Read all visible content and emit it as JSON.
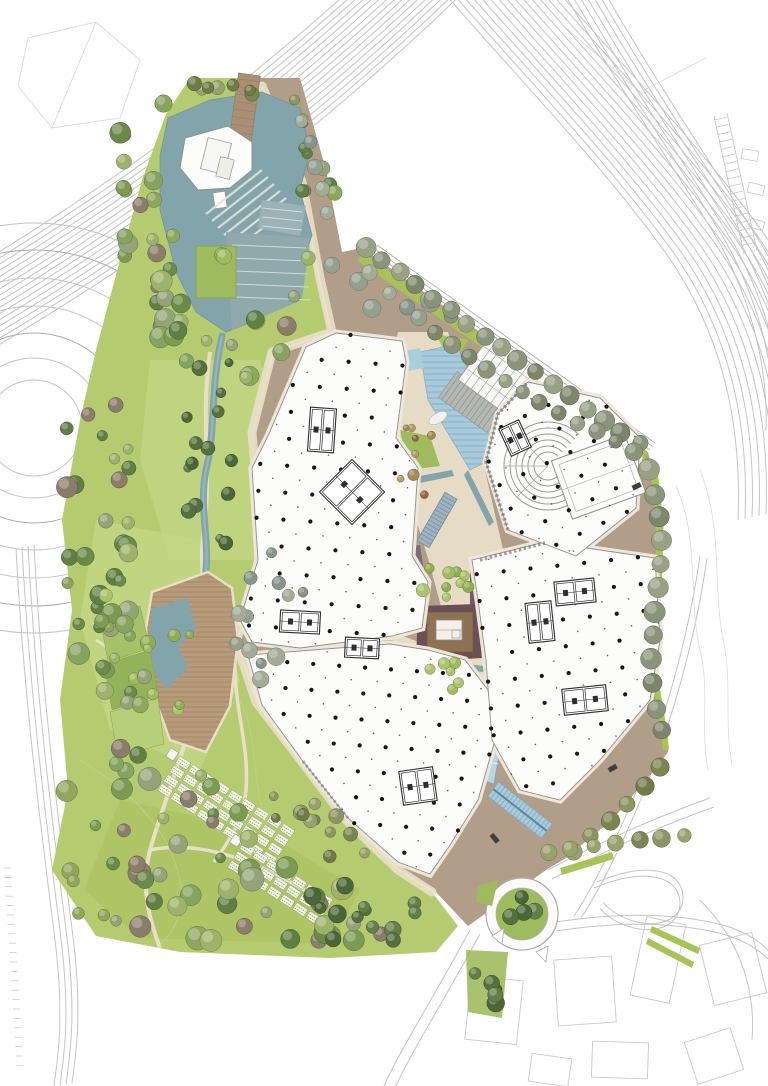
{
  "meta": {
    "type": "architectural-masterplan-site-plan",
    "description": "Rendered aerial site plan: central campus buildings with column grids, landscaped park with trees and water features, surrounded by highway infrastructure"
  },
  "colors": {
    "background": "#ffffff",
    "road_line": "#c4c4c4",
    "road_line_dark": "#ababab",
    "context_line": "#c9c9c9",
    "contour_line": "#dcdcd8",
    "meadow_contour": "#c2d08e",
    "park_green": "#b4cc6f",
    "meadow_light": "#c3d784",
    "meadow_dark": "#aac25f",
    "verge_green": "#a7c455",
    "lawn_bright": "#9ebb5e",
    "plaza_brown": "#b19e88",
    "plaza_brown_dark": "#a08c76",
    "path_cream": "#e9dfc8",
    "deck_wood": "#b79b79",
    "deck_plank": "#a2886a",
    "jetty_wood": "#a98f74",
    "water_teal": "#82a5ab",
    "water_edge": "#6e959c",
    "pool_blue": "#a9cddb",
    "channel_blue": "#b5d6e2",
    "cascade_blue": "#a8cbdb",
    "cascade_line": "#7fa6bc",
    "terrace_steel": "#8fa9ad",
    "terrace_steel_light": "#9bb3b6",
    "step_line": "#cfdcdc",
    "building_fill": "#fcfcfa",
    "building_stroke": "#8f8f8f",
    "building_halo": "#eee6d6",
    "detail_stroke": "#2e2e2e",
    "column_dot": "#151515",
    "glass_fill": "#f7f8f5",
    "glass_line": "#9a9a9a",
    "stair_fill": "#b3b8b2",
    "stair_line": "#8f948e",
    "bed_purple": "#7e6879",
    "bed_purple_dark": "#6f5a6e",
    "bed_maroon": "#6d4f56",
    "court_brown": "#8d7354",
    "court_pavilion": "#f4f0e8",
    "planter_blue": "#9db3c0",
    "planter_line": "#6f8896",
    "car_dark": "#3f3f3f",
    "allotment_fill": "#f2f4ea",
    "allotment_line": "#7f9a4e",
    "allotment_border": "#9aa86b"
  },
  "palettes": {
    "mixed": [
      "#7c9a52",
      "#8fa75c",
      "#6b8a49",
      "#9db26a",
      "#86a35f",
      "#5f7f45",
      "#94a478",
      "#8a7d6a"
    ],
    "olive": [
      "#8d9563",
      "#7b854f",
      "#9aa26b",
      "#6f7a48"
    ],
    "dark": [
      "#55703f",
      "#637e48",
      "#4c6639"
    ],
    "grey": [
      "#95a18f",
      "#86948a",
      "#a3ab97"
    ],
    "autumn": [
      "#a58a57",
      "#b39a62",
      "#9c6248"
    ],
    "allee": [
      "#8b9379",
      "#7d866b",
      "#99a184"
    ],
    "bright": [
      "#9ebb5e",
      "#a9c46a",
      "#8fae52"
    ]
  },
  "vegetation": {
    "clusters": [
      {
        "name": "pond-west-band",
        "poly": [
          [
            118,
            120
          ],
          [
            168,
            100
          ],
          [
            186,
            150
          ],
          [
            172,
            250
          ],
          [
            196,
            320
          ],
          [
            160,
            346
          ],
          [
            120,
            250
          ],
          [
            108,
            170
          ]
        ],
        "count": 26,
        "rmin": 5,
        "rmax": 11,
        "palette": "mixed"
      },
      {
        "name": "pond-north",
        "poly": [
          [
            188,
            82
          ],
          [
            258,
            74
          ],
          [
            268,
            100
          ],
          [
            200,
            112
          ]
        ],
        "count": 7,
        "rmin": 4,
        "rmax": 8,
        "palette": "olive"
      },
      {
        "name": "pond-east",
        "poly": [
          [
            296,
            108
          ],
          [
            326,
            128
          ],
          [
            338,
            212
          ],
          [
            306,
            262
          ],
          [
            288,
            190
          ]
        ],
        "count": 8,
        "rmin": 5,
        "rmax": 9,
        "palette": "mixed"
      },
      {
        "name": "pond-south",
        "poly": [
          [
            165,
            300
          ],
          [
            298,
            296
          ],
          [
            318,
            350
          ],
          [
            240,
            386
          ],
          [
            176,
            362
          ]
        ],
        "count": 14,
        "rmin": 5,
        "rmax": 10,
        "palette": "mixed"
      },
      {
        "name": "stream-band",
        "poly": [
          [
            184,
            360
          ],
          [
            230,
            356
          ],
          [
            236,
            560
          ],
          [
            196,
            572
          ],
          [
            178,
            460
          ]
        ],
        "count": 16,
        "rmin": 4,
        "rmax": 8,
        "palette": "dark"
      },
      {
        "name": "park-mid-west",
        "poly": [
          [
            62,
            420
          ],
          [
            120,
            380
          ],
          [
            140,
            520
          ],
          [
            150,
            640
          ],
          [
            110,
            700
          ],
          [
            66,
            660
          ],
          [
            58,
            540
          ]
        ],
        "count": 28,
        "rmin": 5,
        "rmax": 11,
        "palette": "mixed"
      },
      {
        "name": "deck-east-grove",
        "poly": [
          [
            236,
            560
          ],
          [
            300,
            546
          ],
          [
            310,
            640
          ],
          [
            262,
            700
          ],
          [
            236,
            650
          ]
        ],
        "count": 12,
        "rmin": 5,
        "rmax": 9,
        "palette": "grey"
      },
      {
        "name": "park-south-dense",
        "poly": [
          [
            60,
            760
          ],
          [
            160,
            740
          ],
          [
            260,
            800
          ],
          [
            340,
            860
          ],
          [
            400,
            900
          ],
          [
            390,
            950
          ],
          [
            92,
            940
          ],
          [
            48,
            860
          ]
        ],
        "count": 52,
        "rmin": 5,
        "rmax": 12,
        "palette": "mixed"
      },
      {
        "name": "meadow-singles",
        "poly": [
          [
            92,
            560
          ],
          [
            208,
            560
          ],
          [
            248,
            700
          ],
          [
            200,
            760
          ],
          [
            112,
            720
          ]
        ],
        "count": 9,
        "rmin": 4,
        "rmax": 8,
        "palette": "bright"
      },
      {
        "name": "allotment-fringe",
        "poly": [
          [
            270,
            760
          ],
          [
            350,
            790
          ],
          [
            380,
            850
          ],
          [
            320,
            862
          ],
          [
            258,
            820
          ]
        ],
        "count": 12,
        "rmin": 4,
        "rmax": 8,
        "palette": "olive"
      },
      {
        "name": "south-plaza-grove",
        "poly": [
          [
            300,
            862
          ],
          [
            420,
            902
          ],
          [
            400,
            950
          ],
          [
            300,
            942
          ]
        ],
        "count": 13,
        "rmin": 5,
        "rmax": 10,
        "palette": "dark"
      },
      {
        "name": "spine-grove",
        "poly": [
          [
            420,
            560
          ],
          [
            468,
            566
          ],
          [
            470,
            612
          ],
          [
            424,
            606
          ]
        ],
        "count": 9,
        "rmin": 4,
        "rmax": 7,
        "palette": "bright"
      },
      {
        "name": "spine-grove-2",
        "poly": [
          [
            426,
            650
          ],
          [
            470,
            657
          ],
          [
            462,
            694
          ],
          [
            428,
            688
          ]
        ],
        "count": 6,
        "rmin": 3,
        "rmax": 6,
        "palette": "bright"
      },
      {
        "name": "spine-autumn",
        "poly": [
          [
            398,
            408
          ],
          [
            432,
            430
          ],
          [
            428,
            508
          ],
          [
            400,
            492
          ]
        ],
        "count": 8,
        "rmin": 3,
        "rmax": 6,
        "palette": "autumn"
      },
      {
        "name": "plaza-grove",
        "poly": [
          [
            330,
            258
          ],
          [
            468,
            302
          ],
          [
            458,
            338
          ],
          [
            338,
            312
          ]
        ],
        "count": 10,
        "rmin": 6,
        "rmax": 10,
        "palette": "grey"
      },
      {
        "name": "roundabout-south-patch",
        "poly": [
          [
            468,
            952
          ],
          [
            506,
            956
          ],
          [
            500,
            1016
          ],
          [
            470,
            1010
          ]
        ],
        "count": 5,
        "rmin": 5,
        "rmax": 9,
        "palette": "dark"
      },
      {
        "name": "terrace-west-band",
        "poly": [
          [
            96,
            616
          ],
          [
            148,
            600
          ],
          [
            160,
            740
          ],
          [
            120,
            772
          ],
          [
            92,
            700
          ]
        ],
        "count": 13,
        "rmin": 5,
        "rmax": 10,
        "palette": "mixed"
      },
      {
        "name": "roundabout-centre",
        "poly": [
          [
            504,
            898
          ],
          [
            540,
            896
          ],
          [
            544,
            928
          ],
          [
            506,
            932
          ]
        ],
        "count": 4,
        "rmin": 6,
        "rmax": 9,
        "palette": "dark"
      },
      {
        "name": "pond-garden",
        "poly": [
          [
            198,
            248
          ],
          [
            234,
            248
          ],
          [
            234,
            298
          ],
          [
            198,
            298
          ]
        ],
        "count": 2,
        "rmin": 6,
        "rmax": 9,
        "palette": "bright"
      },
      {
        "name": "top-strip",
        "poly": [
          [
            286,
            96
          ],
          [
            300,
            92
          ],
          [
            310,
            130
          ],
          [
            296,
            134
          ]
        ],
        "count": 3,
        "rmin": 4,
        "rmax": 6,
        "palette": "olive"
      }
    ],
    "rows": [
      {
        "name": "allee-upper",
        "pts": [
          [
            366,
            248
          ],
          [
            460,
            318
          ],
          [
            560,
            390
          ],
          [
            648,
            450
          ]
        ],
        "spacing": 21,
        "r": 9,
        "palette": "allee"
      },
      {
        "name": "allee-lower",
        "pts": [
          [
            436,
            332
          ],
          [
            530,
            398
          ],
          [
            640,
            455
          ]
        ],
        "spacing": 21,
        "r": 8,
        "palette": "allee"
      },
      {
        "name": "right-edge-row",
        "pts": [
          [
            650,
            470
          ],
          [
            662,
            528
          ],
          [
            658,
            594
          ],
          [
            650,
            650
          ],
          [
            656,
            706
          ],
          [
            664,
            748
          ]
        ],
        "spacing": 24,
        "r": 10,
        "palette": "allee"
      },
      {
        "name": "southeast-edge-row",
        "pts": [
          [
            660,
            768
          ],
          [
            616,
            816
          ],
          [
            566,
            856
          ]
        ],
        "spacing": 24,
        "r": 9,
        "palette": "olive"
      },
      {
        "name": "bottom-road-row",
        "pts": [
          [
            548,
            852
          ],
          [
            596,
            846
          ],
          [
            644,
            840
          ],
          [
            690,
            836
          ]
        ],
        "spacing": 23,
        "r": 8,
        "palette": "olive"
      },
      {
        "name": "corridor-row",
        "pts": [
          [
            302,
            120
          ],
          [
            318,
            172
          ],
          [
            330,
            226
          ]
        ],
        "spacing": 24,
        "r": 7,
        "palette": "grey"
      }
    ]
  },
  "structure": {
    "column_grids": [
      {
        "name": "building-nw",
        "poly": [
          [
            306,
            347
          ],
          [
            336,
            333
          ],
          [
            402,
            341
          ],
          [
            406,
            362
          ],
          [
            396,
            438
          ],
          [
            418,
            468
          ],
          [
            412,
            556
          ],
          [
            428,
            582
          ],
          [
            422,
            628
          ],
          [
            392,
            636
          ],
          [
            300,
            648
          ],
          [
            252,
            642
          ],
          [
            240,
            620
          ],
          [
            258,
            560
          ],
          [
            252,
            468
          ],
          [
            268,
            436
          ]
        ],
        "spacing": 27,
        "angle": 4
      },
      {
        "name": "building-sw",
        "poly": [
          [
            248,
            655
          ],
          [
            390,
            644
          ],
          [
            428,
            650
          ],
          [
            465,
            660
          ],
          [
            488,
            690
          ],
          [
            495,
            740
          ],
          [
            478,
            800
          ],
          [
            450,
            845
          ],
          [
            430,
            874
          ],
          [
            398,
            862
          ],
          [
            348,
            818
          ],
          [
            302,
            760
          ],
          [
            262,
            705
          ]
        ],
        "spacing": 26,
        "angle": 4
      },
      {
        "name": "building-e",
        "poly": [
          [
            472,
            560
          ],
          [
            545,
            542
          ],
          [
            655,
            558
          ],
          [
            660,
            640
          ],
          [
            650,
            700
          ],
          [
            600,
            760
          ],
          [
            560,
            800
          ],
          [
            520,
            790
          ],
          [
            492,
            740
          ],
          [
            486,
            660
          ],
          [
            478,
            600
          ]
        ],
        "spacing": 27,
        "angle": -6
      },
      {
        "name": "building-ne",
        "poly": [
          [
            528,
            382
          ],
          [
            600,
            398
          ],
          [
            640,
            438
          ],
          [
            636,
            508
          ],
          [
            576,
            556
          ],
          [
            508,
            530
          ],
          [
            486,
            462
          ],
          [
            498,
            414
          ]
        ],
        "spacing": 26,
        "angle": -25
      }
    ],
    "cores": [
      {
        "x": 352,
        "y": 492,
        "w": 46,
        "h": 46,
        "rot": 45
      },
      {
        "x": 300,
        "y": 622,
        "w": 40,
        "h": 22,
        "rot": 3
      },
      {
        "x": 362,
        "y": 648,
        "w": 34,
        "h": 20,
        "rot": 3
      },
      {
        "x": 418,
        "y": 786,
        "w": 34,
        "h": 34,
        "rot": -8
      },
      {
        "x": 575,
        "y": 592,
        "w": 40,
        "h": 24,
        "rot": -6
      },
      {
        "x": 585,
        "y": 700,
        "w": 44,
        "h": 26,
        "rot": -6
      },
      {
        "x": 540,
        "y": 622,
        "w": 26,
        "h": 40,
        "rot": -6
      },
      {
        "x": 322,
        "y": 430,
        "w": 26,
        "h": 44,
        "rot": 4
      },
      {
        "x": 515,
        "y": 438,
        "w": 22,
        "h": 30,
        "rot": -25
      }
    ]
  },
  "agriculture": {
    "strips": [
      {
        "x": 180,
        "y": 756,
        "angle": 33,
        "lanes": 4,
        "cols": 9,
        "pw": 13,
        "ph": 8,
        "gap": 2.5,
        "lane_gap": 3
      },
      {
        "x": 244,
        "y": 842,
        "angle": 33,
        "lanes": 3,
        "cols": 7,
        "pw": 13,
        "ph": 8,
        "gap": 2.5,
        "lane_gap": 3
      }
    ]
  }
}
